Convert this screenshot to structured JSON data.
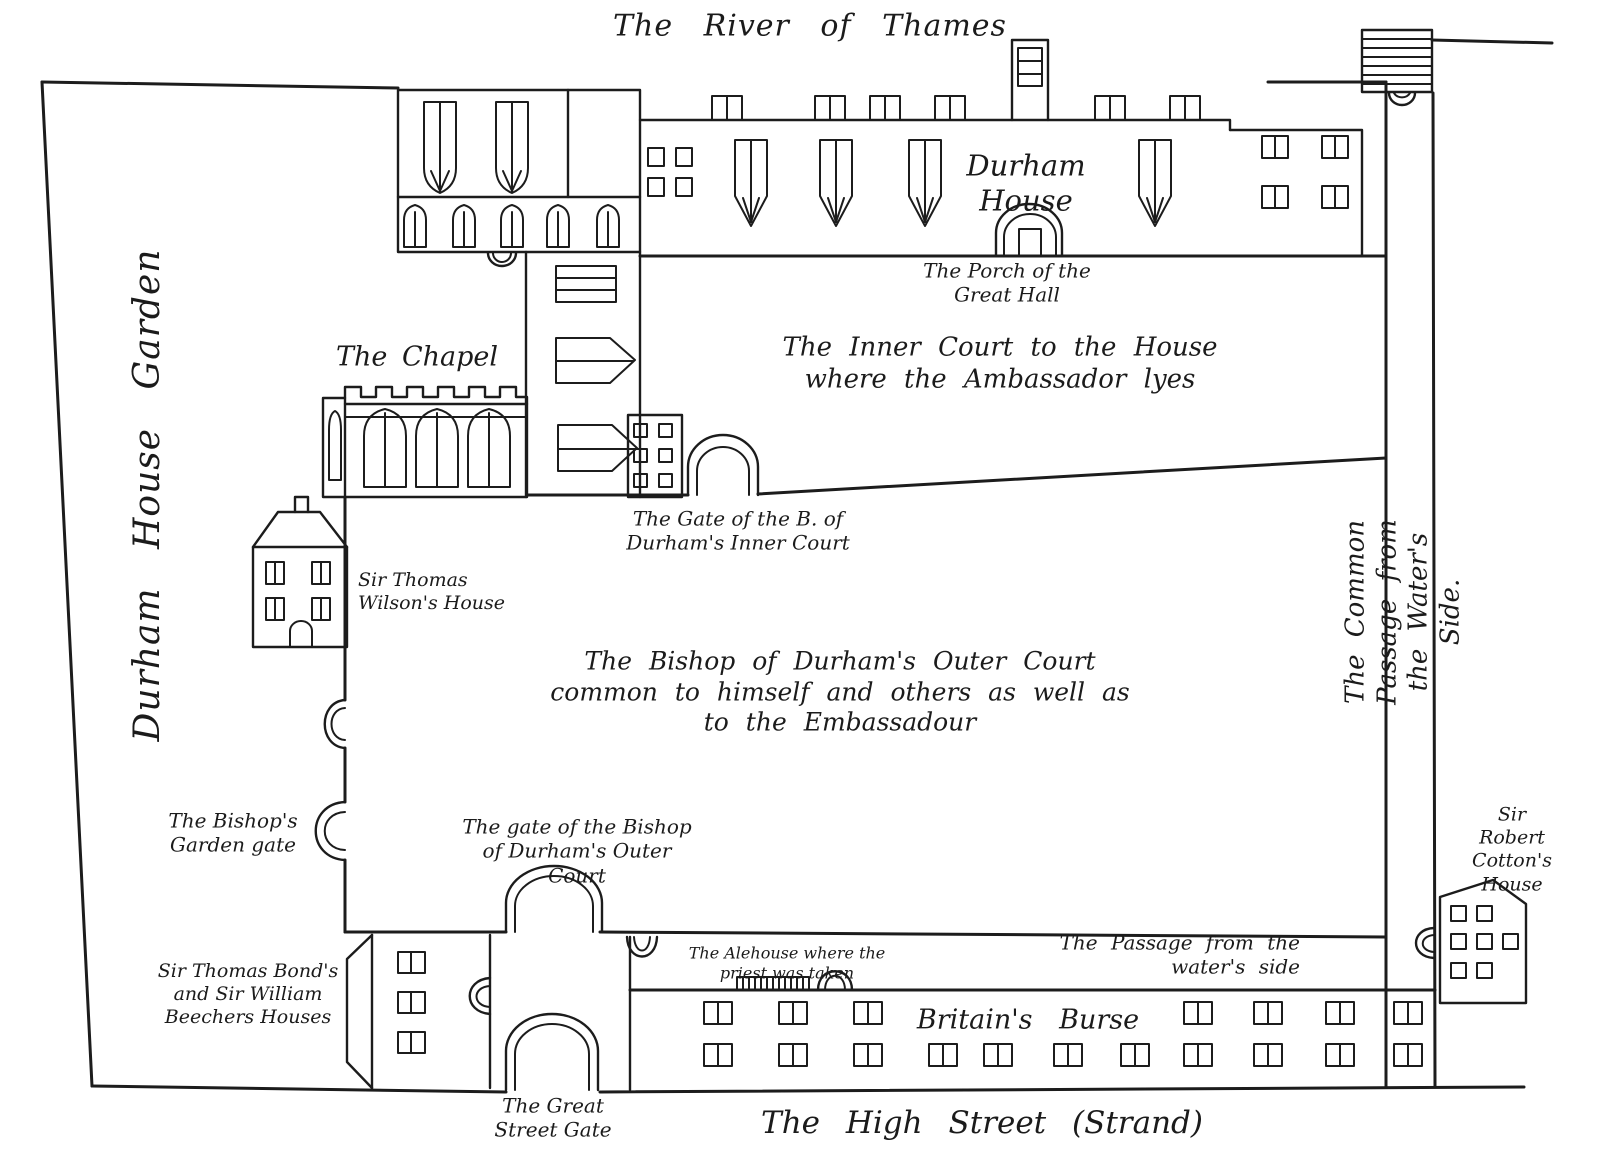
{
  "map": {
    "title": "Plan of Durham House",
    "colors": {
      "ink": "#1c1c1c",
      "paper": "#ffffff"
    },
    "labels": {
      "river": "The River of Thames",
      "garden": "Durham House Garden",
      "durham_house": "Durham\nHouse",
      "porch": "The Porch of the\nGreat Hall",
      "inner_court": "The Inner Court to the House\nwhere the Ambassador lyes",
      "chapel": "The Chapel",
      "inner_gate": "The Gate of the B. of\nDurham's Inner Court",
      "wilson": "Sir Thomas\nWilson's House",
      "outer_court": "The Bishop of Durham's Outer Court\ncommon to himself and others as well as\nto the Embassadour",
      "garden_gate": "The Bishop's\nGarden gate",
      "outer_gate": "The gate of the Bishop\nof Durham's Outer\nCourt",
      "bonds": "Sir Thomas Bond's\nand Sir William\nBeechers Houses",
      "alehouse": "The Alehouse where the\npriest was taken",
      "passage": "The Passage from the\nwater's side",
      "burse": "Britain's Burse",
      "great_gate": "The Great\nStreet Gate",
      "high_street": "The High Street (Strand)",
      "common_passage": "The Common Passage from the Water's Side.",
      "cotton": "Sir Robert\nCotton's\nHouse"
    }
  }
}
